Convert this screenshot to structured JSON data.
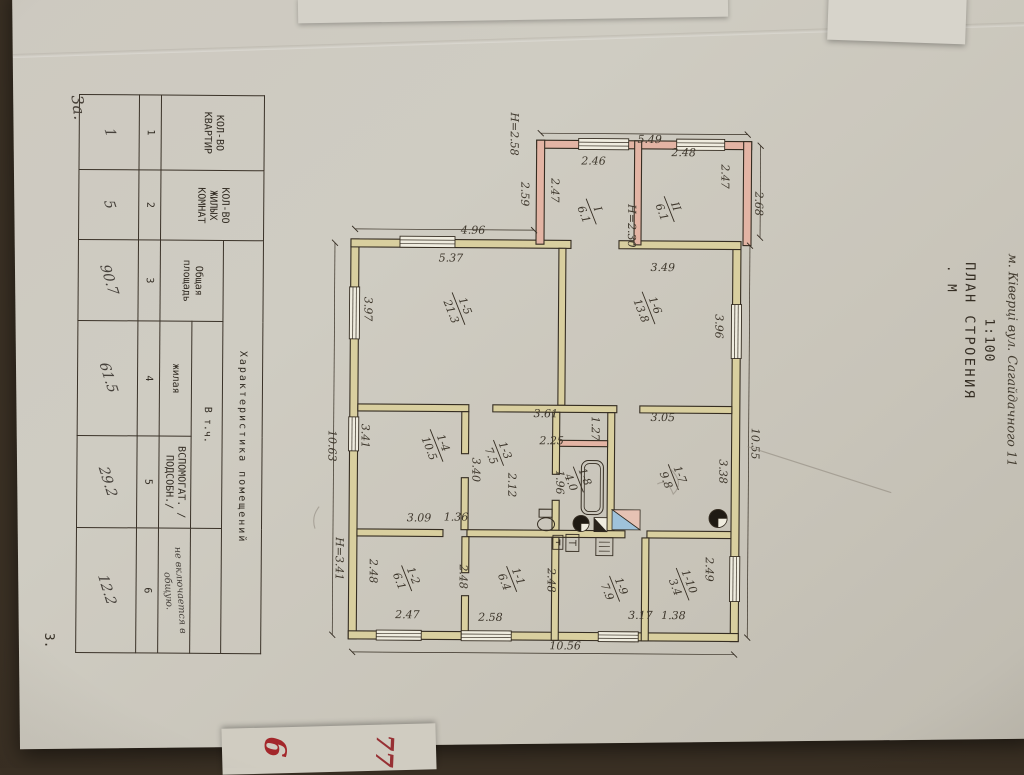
{
  "page": {
    "address": "м. Ківерці  вул. Сагайдачного 11",
    "sheet_note": "3а.",
    "page_number": "3.",
    "red_note_1": "6",
    "red_note_2": "77"
  },
  "title": {
    "scale_top": "1:100",
    "main": "ПЛАН СТРОЕНИЯ",
    "scale_label": ".  М"
  },
  "table": {
    "title": "Характеристика  помещений",
    "col1": "КОЛ-ВО КВАРТИР",
    "col2": "КОЛ-ВО ЖИЛЫХ КОМНАТ",
    "col3": "Общая площадь",
    "vtch": "В т.ч.",
    "col4": "жилая",
    "col5": "ВСПОМОГАТ. /ПОДСОБН./",
    "col6_note": "не включается в общую.",
    "numbers": [
      "1",
      "2",
      "3",
      "4",
      "5",
      "6"
    ],
    "values": [
      "1",
      "5",
      "90.7",
      "61.5",
      "29.2",
      "12.2"
    ]
  },
  "plan": {
    "colors": {
      "ink": "#352d22",
      "wall_y": "#d9cf9f",
      "wall_p": "#e3b4a4",
      "win": "#efecdf",
      "blue": "#9fc2da",
      "pink": "#e6c2b4",
      "pencil": "#8b8378"
    },
    "walls": [
      [
        228,
        280,
        400,
        8,
        "y"
      ],
      [
        228,
        662,
        400,
        8,
        "y"
      ],
      [
        228,
        280,
        8,
        122,
        "y"
      ],
      [
        228,
        450,
        8,
        220,
        "y"
      ],
      [
        620,
        280,
        8,
        390,
        "y"
      ],
      [
        128,
        270,
        8,
        215,
        "p"
      ],
      [
        128,
        270,
        104,
        8,
        "p"
      ],
      [
        128,
        477,
        104,
        8,
        "p"
      ],
      [
        128,
        380,
        104,
        7,
        "p"
      ],
      [
        236,
        455,
        157,
        7,
        "y"
      ],
      [
        393,
        288,
        7,
        92,
        "y"
      ],
      [
        393,
        403,
        7,
        124,
        "y"
      ],
      [
        393,
        551,
        7,
        111,
        "y"
      ],
      [
        400,
        405,
        118,
        7,
        "y"
      ],
      [
        400,
        460,
        62,
        7,
        "y"
      ],
      [
        488,
        460,
        30,
        7,
        "y"
      ],
      [
        428,
        412,
        6,
        48,
        "p"
      ],
      [
        518,
        288,
        7,
        84,
        "y"
      ],
      [
        518,
        394,
        7,
        158,
        "y"
      ],
      [
        518,
        576,
        7,
        86,
        "y"
      ],
      [
        525,
        370,
        103,
        7,
        "y"
      ],
      [
        525,
        460,
        103,
        7,
        "y"
      ],
      [
        525,
        550,
        36,
        7,
        "y"
      ],
      [
        584,
        550,
        44,
        7,
        "y"
      ],
      [
        400,
        551,
        42,
        7,
        "y"
      ],
      [
        466,
        551,
        52,
        7,
        "y"
      ]
    ],
    "windows": [
      [
        225,
        566,
        11,
        55,
        "v"
      ],
      [
        276,
        661,
        52,
        10,
        "h"
      ],
      [
        406,
        661,
        34,
        10,
        "h"
      ],
      [
        291,
        279,
        54,
        10,
        "h"
      ],
      [
        543,
        279,
        45,
        10,
        "h"
      ],
      [
        619,
        597,
        10,
        45,
        "v"
      ],
      [
        619,
        507,
        10,
        50,
        "v"
      ],
      [
        619,
        380,
        10,
        40,
        "v"
      ],
      [
        126,
        393,
        11,
        50,
        "v"
      ],
      [
        126,
        297,
        11,
        48,
        "v"
      ]
    ],
    "dlines": [
      [
        232,
        271,
        624,
        271
      ],
      [
        232,
        686,
        624,
        686
      ],
      [
        641,
        284,
        641,
        666
      ],
      [
        121,
        274,
        121,
        481
      ],
      [
        218,
        487,
        218,
        666
      ],
      [
        132,
        261,
        224,
        261
      ]
    ],
    "dims": [
      {
        "t": "2.47",
        "x": 178,
        "y": 470,
        "o": "h"
      },
      {
        "t": "2.47",
        "x": 163,
        "y": 300,
        "o": "h"
      },
      {
        "t": "Н=2.30",
        "x": 213,
        "y": 393,
        "o": "h"
      },
      {
        "t": "2.59",
        "x": 182,
        "y": 500,
        "o": "h"
      },
      {
        "t": "Н=2.58",
        "x": 122,
        "y": 511,
        "o": "h"
      },
      {
        "t": "2.68",
        "x": 190,
        "y": 266,
        "o": "h"
      },
      {
        "t": "10.55",
        "x": 430,
        "y": 268,
        "o": "h"
      },
      {
        "t": "3.96",
        "x": 313,
        "y": 305,
        "o": "h"
      },
      {
        "t": "3.38",
        "x": 458,
        "y": 300,
        "o": "h"
      },
      {
        "t": "1.27",
        "x": 416,
        "y": 428,
        "o": "h"
      },
      {
        "t": "1.96",
        "x": 470,
        "y": 463,
        "o": "h"
      },
      {
        "t": "2.12",
        "x": 473,
        "y": 511,
        "o": "h"
      },
      {
        "t": "3.40",
        "x": 458,
        "y": 547,
        "o": "h"
      },
      {
        "t": "3.41",
        "x": 425,
        "y": 658,
        "o": "h"
      },
      {
        "t": "10.63",
        "x": 435,
        "y": 691,
        "o": "h"
      },
      {
        "t": "Н=3.41",
        "x": 548,
        "y": 683,
        "o": "h"
      },
      {
        "t": "2.49",
        "x": 556,
        "y": 313,
        "o": "h"
      },
      {
        "t": "2.48",
        "x": 568,
        "y": 471,
        "o": "h"
      },
      {
        "t": "2.48",
        "x": 565,
        "y": 559,
        "o": "h"
      },
      {
        "t": "2.48",
        "x": 560,
        "y": 649,
        "o": "h"
      },
      {
        "t": "3.97",
        "x": 298,
        "y": 656,
        "o": "h"
      },
      {
        "t": "5.49",
        "x": 130,
        "y": 372,
        "o": "v"
      },
      {
        "t": "2.48",
        "x": 143,
        "y": 338,
        "o": "v"
      },
      {
        "t": "2.46",
        "x": 152,
        "y": 428,
        "o": "v"
      },
      {
        "t": "4.96",
        "x": 222,
        "y": 548,
        "o": "v"
      },
      {
        "t": "5.37",
        "x": 250,
        "y": 570,
        "o": "v"
      },
      {
        "t": "3.49",
        "x": 258,
        "y": 358,
        "o": "v"
      },
      {
        "t": "3.05",
        "x": 408,
        "y": 357,
        "o": "v"
      },
      {
        "t": "3.61",
        "x": 405,
        "y": 474,
        "o": "v"
      },
      {
        "t": "2.25",
        "x": 432,
        "y": 468,
        "o": "v"
      },
      {
        "t": "1.36",
        "x": 509,
        "y": 563,
        "o": "v"
      },
      {
        "t": "3.09",
        "x": 510,
        "y": 600,
        "o": "v"
      },
      {
        "t": "2.47",
        "x": 607,
        "y": 611,
        "o": "v"
      },
      {
        "t": "2.58",
        "x": 609,
        "y": 528,
        "o": "v"
      },
      {
        "t": "3.17",
        "x": 606,
        "y": 378,
        "o": "v"
      },
      {
        "t": "1.38",
        "x": 606,
        "y": 345,
        "o": "v"
      },
      {
        "t": "10.56",
        "x": 637,
        "y": 453,
        "o": "v"
      }
    ],
    "rooms": [
      {
        "n": "II",
        "a": "6.1",
        "x": 196,
        "y": 352
      },
      {
        "n": "I",
        "a": "6.1",
        "x": 199,
        "y": 430
      },
      {
        "n": "1-6",
        "a": "13.8",
        "x": 295,
        "y": 372
      },
      {
        "n": "1-5",
        "a": "21.3",
        "x": 297,
        "y": 562
      },
      {
        "n": "1-7",
        "a": "9.8",
        "x": 464,
        "y": 346
      },
      {
        "n": "1-8",
        "a": "4.0",
        "x": 467,
        "y": 441
      },
      {
        "n": "1-3",
        "a": "7.5",
        "x": 441,
        "y": 521
      },
      {
        "n": "1-4",
        "a": "10.5",
        "x": 434,
        "y": 583
      },
      {
        "n": "1-1",
        "a": "6.4",
        "x": 567,
        "y": 507
      },
      {
        "n": "1-2",
        "a": "6.1",
        "x": 567,
        "y": 612
      },
      {
        "n": "1-9",
        "a": "7.9",
        "x": 576,
        "y": 404
      },
      {
        "n": "1-10",
        "a": "3.4",
        "x": 571,
        "y": 336
      }
    ],
    "fixtures": [
      {
        "t": "tub",
        "x": 448,
        "y": 416,
        "w": 54,
        "h": 22
      },
      {
        "t": "wc",
        "x": 497,
        "y": 463
      },
      {
        "t": "sc",
        "cx": 511,
        "cy": 438,
        "r": 8
      },
      {
        "t": "sc",
        "cx": 505,
        "cy": 301,
        "r": 9
      },
      {
        "t": "sq",
        "x": 497,
        "y": 379,
        "w": 20,
        "h": 28
      },
      {
        "t": "tri",
        "x": 505,
        "y": 412,
        "w": 14,
        "h": 13
      },
      {
        "t": "bt",
        "x": 522,
        "y": 440,
        "w": 17,
        "h": 13
      },
      {
        "t": "bt",
        "x": 523,
        "y": 456,
        "w": 14,
        "h": 10
      },
      {
        "t": "gr",
        "x": 525,
        "y": 406,
        "w": 18,
        "h": 17
      }
    ],
    "scribbles": [
      "M433,272 L478,128",
      "M455,350 q14,-16 26,-4 q-16,6 -10,16",
      "M496,700 q10,8 22,4"
    ]
  }
}
